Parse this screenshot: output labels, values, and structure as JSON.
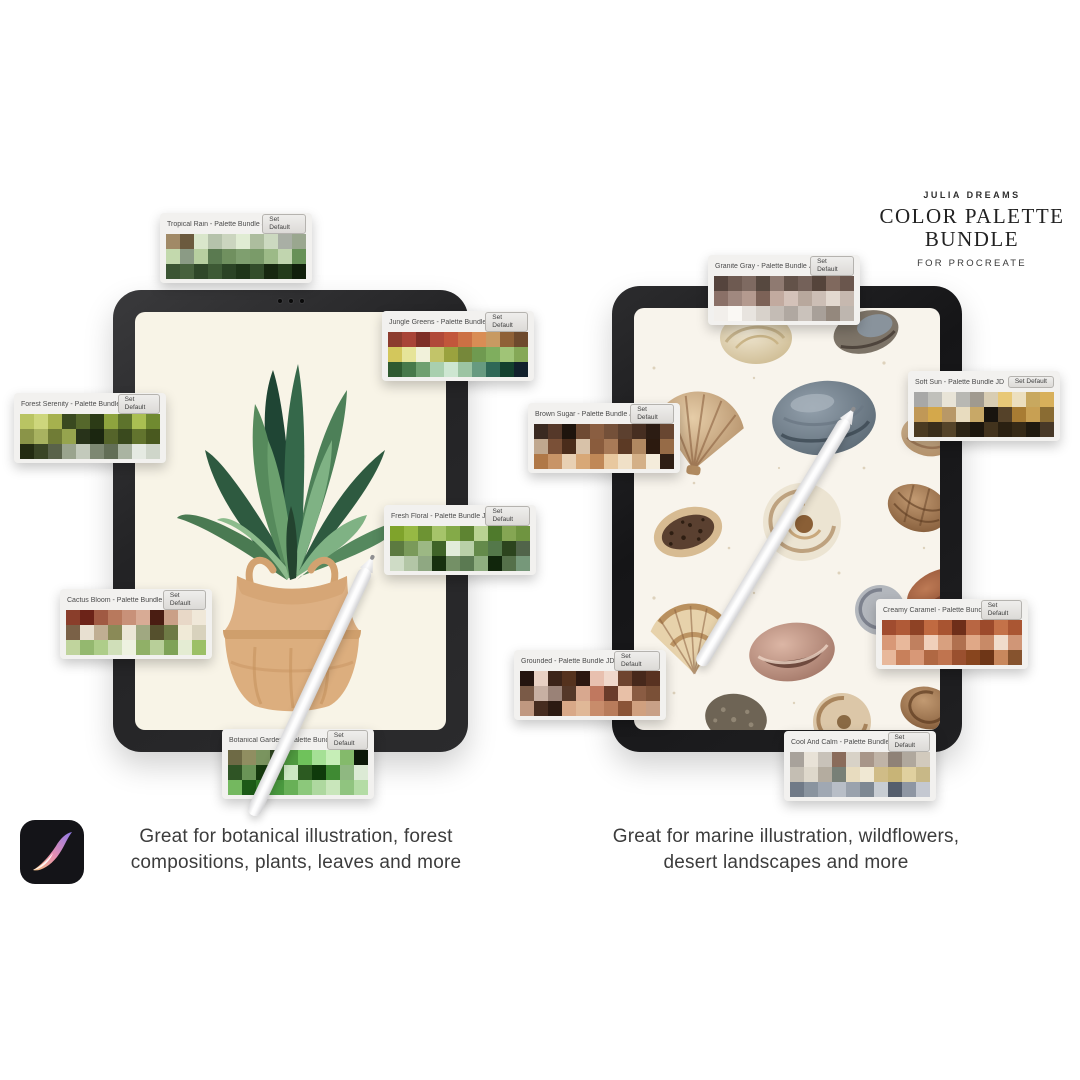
{
  "header": {
    "brand": "JULIA DREAMS",
    "title_line1": "COLOR PALETTE",
    "title_line2": "BUNDLE",
    "subtitle": "FOR PROCREATE"
  },
  "captions": {
    "left": "Great for botanical illustration, forest compositions, plants, leaves and more",
    "right": "Great for marine illustration, wildflowers, desert landscapes and more"
  },
  "palette_ui": {
    "set_default_label": "Set Default"
  },
  "icons": {
    "procreate": "procreate-app-icon"
  },
  "palettes": [
    {
      "name": "Tropical Rain - Palette Bundle JD",
      "rows": [
        [
          "#a18a67",
          "#6b5a3e",
          "#d9e6cb",
          "#b5c2ab",
          "#cbd5bf",
          "#e0ecd3",
          "#adbd9e",
          "#ccd9c0",
          "#a9afa5",
          "#9aa78f"
        ],
        [
          "#c3d9ad",
          "#8b9b85",
          "#b7cfa0",
          "#5a7a50",
          "#70905f",
          "#7f9f6f",
          "#7a9b69",
          "#9cba87",
          "#c1d5af",
          "#679157"
        ],
        [
          "#3b5533",
          "#47613d",
          "#2f4729",
          "#3d5935",
          "#2b4325",
          "#1f3519",
          "#334d2b",
          "#172810",
          "#233b1b",
          "#101f0b"
        ]
      ]
    },
    {
      "name": "Jungle Greens - Palette Bundle JD",
      "rows": [
        [
          "#8c3c2e",
          "#a84437",
          "#7e2f27",
          "#b04939",
          "#c2563b",
          "#cc7044",
          "#d98d55",
          "#c89a62",
          "#8f6137",
          "#6e4a2d"
        ],
        [
          "#d3c75c",
          "#e6e499",
          "#f1f1da",
          "#c2c469",
          "#9aa23e",
          "#76883a",
          "#6f9a50",
          "#7fae5e",
          "#a0c477",
          "#85a857"
        ],
        [
          "#2f5a30",
          "#47794a",
          "#6fa070",
          "#a9cfae",
          "#cde6d1",
          "#9cc4a3",
          "#679a80",
          "#2f6857",
          "#13402e",
          "#11202c"
        ]
      ]
    },
    {
      "name": "Forest Serenity - Palette Bundle JD",
      "rows": [
        [
          "#b9c463",
          "#cdd67c",
          "#a6b14e",
          "#39491f",
          "#55672b",
          "#2c3b16",
          "#8ea43e",
          "#5d732c",
          "#aabf52",
          "#708a30"
        ],
        [
          "#8a9448",
          "#a8b260",
          "#707c36",
          "#96a44e",
          "#28331a",
          "#1b2610",
          "#55642a",
          "#3a4a1e",
          "#62742e",
          "#49591f"
        ],
        [
          "#232b12",
          "#3a4526",
          "#59624a",
          "#9aa48e",
          "#c3cabc",
          "#7d8872",
          "#626e56",
          "#aab4a2",
          "#e5eae2",
          "#cfd6ca"
        ]
      ]
    },
    {
      "name": "Fresh Floral - Palette Bundle JD",
      "rows": [
        [
          "#7fa32b",
          "#97b944",
          "#6d9333",
          "#a6c46a",
          "#84aa48",
          "#5e8432",
          "#b9d292",
          "#4f7a2c",
          "#85a653",
          "#6f9440"
        ],
        [
          "#5c7a40",
          "#7a9a5a",
          "#9cb884",
          "#3f6328",
          "#e2ecda",
          "#b9d0a8",
          "#648a4a",
          "#54784a",
          "#2c441e",
          "#51644a"
        ],
        [
          "#cfdcc6",
          "#b3c6a6",
          "#8fa882",
          "#17300f",
          "#749066",
          "#5b7a52",
          "#8fae80",
          "#11260c",
          "#55704a",
          "#76987a"
        ]
      ]
    },
    {
      "name": "Cactus Bloom - Palette Bundle JD",
      "rows": [
        [
          "#8a3e2b",
          "#6c2318",
          "#a05a43",
          "#b8795d",
          "#c89179",
          "#d8ab95",
          "#4a1d12",
          "#caa087",
          "#e8d8c7",
          "#f0e8d9"
        ],
        [
          "#7a6147",
          "#e8e0d1",
          "#c0ae93",
          "#8a8a57",
          "#ece6d7",
          "#a0a881",
          "#55502d",
          "#6e7a45",
          "#f0ead7",
          "#d8d2bd"
        ],
        [
          "#c0d49d",
          "#94b86f",
          "#aecd89",
          "#d0dfb9",
          "#eef2e1",
          "#90b067",
          "#b8cf99",
          "#7ea257",
          "#e4ecd3",
          "#9cc067"
        ]
      ]
    },
    {
      "name": "Botanical Garden - Palette Bundle JD",
      "rows": [
        [
          "#6e6a45",
          "#908e61",
          "#7a945f",
          "#2c421f",
          "#4f9a3f",
          "#6fc25b",
          "#a5e095",
          "#c6eeb7",
          "#84ba6b",
          "#0c1809"
        ],
        [
          "#2f5425",
          "#6a9457",
          "#163a0f",
          "#3a7a2d",
          "#cde8c3",
          "#2c5a21",
          "#0f3a0b",
          "#3f8a33",
          "#8fb881",
          "#dcead5"
        ],
        [
          "#74b85f",
          "#1c5a17",
          "#2f7a27",
          "#4a9a3f",
          "#68b057",
          "#8cc87b",
          "#aed89f",
          "#c9e6bb",
          "#90c47f",
          "#b4dca5"
        ]
      ]
    },
    {
      "name": "Granite Gray - Palette Bundle JD",
      "rows": [
        [
          "#55443d",
          "#6e5a51",
          "#7e6a61",
          "#56483f",
          "#8f7a71",
          "#635249",
          "#746159",
          "#55443b",
          "#80695e",
          "#6a564d"
        ],
        [
          "#8a7067",
          "#a0887f",
          "#b49a8f",
          "#7c6257",
          "#c2aa9f",
          "#d4c2b9",
          "#b8a89d",
          "#ccbeb5",
          "#e2d8cf",
          "#c6b8af"
        ],
        [
          "#f2efeb",
          "#faf8f4",
          "#e8e4df",
          "#d8d2cb",
          "#c4bcb5",
          "#b0a8a1",
          "#cac2bb",
          "#a8a099",
          "#94887d",
          "#beb6af"
        ]
      ]
    },
    {
      "name": "Soft Sun - Palette Bundle JD",
      "rows": [
        [
          "#a8a8a7",
          "#c0c0bb",
          "#e8e4d7",
          "#b8b8b3",
          "#a09a8f",
          "#d8cdb3",
          "#e8c877",
          "#ecdfbf",
          "#c8a85f",
          "#d8b05b"
        ],
        [
          "#c09857",
          "#d4a84b",
          "#b89867",
          "#e8dcbf",
          "#c8a867",
          "#18140f",
          "#554229",
          "#a87c33",
          "#c8a053",
          "#8a6c33"
        ],
        [
          "#4a3a21",
          "#3a2e1b",
          "#554429",
          "#2c2415",
          "#1c160d",
          "#42331d",
          "#2a2011",
          "#362a17",
          "#201a0f",
          "#473827"
        ]
      ]
    },
    {
      "name": "Brown Sugar - Palette Bundle JD",
      "rows": [
        [
          "#3a2a21",
          "#553829",
          "#1e140d",
          "#6e4a33",
          "#8a5e41",
          "#745039",
          "#5c402f",
          "#462e21",
          "#2c1c13",
          "#684631"
        ],
        [
          "#c0a88f",
          "#7a5037",
          "#4a2c1b",
          "#d8c2a9",
          "#8a5c3d",
          "#a87a57",
          "#5c3a25",
          "#b08861",
          "#2c1a0f",
          "#966b47"
        ],
        [
          "#b07847",
          "#c89467",
          "#e8d0b3",
          "#d8a877",
          "#c08857",
          "#e8c89f",
          "#f0e0c7",
          "#d4b087",
          "#f4ecdb",
          "#2e1e15"
        ]
      ]
    },
    {
      "name": "Creamy Caramel - Palette Bundle JD",
      "rows": [
        [
          "#a04c2f",
          "#b05a37",
          "#8e4225",
          "#c06a41",
          "#a85431",
          "#6e2e19",
          "#b86643",
          "#9c4a2b",
          "#c47249",
          "#aa5633"
        ],
        [
          "#d89877",
          "#e8b89b",
          "#c0805f",
          "#f0d0bb",
          "#d8a07f",
          "#b0704f",
          "#e0a887",
          "#c88a67",
          "#f0dccb",
          "#d09677"
        ],
        [
          "#e8b89b",
          "#c8805b",
          "#d89877",
          "#b06843",
          "#c0744f",
          "#9a502f",
          "#88451e",
          "#6e3617",
          "#c8885d",
          "#86532e"
        ]
      ]
    },
    {
      "name": "Grounded - Palette Bundle JD",
      "rows": [
        [
          "#24140f",
          "#e8d0c3",
          "#3c2419",
          "#55321e",
          "#2c1811",
          "#e8c0af",
          "#f0d8cb",
          "#6e442f",
          "#46281b",
          "#583221"
        ],
        [
          "#7a5a47",
          "#c8b0a3",
          "#9a8277",
          "#553829",
          "#d8a88f",
          "#c0785f",
          "#6a3c2b",
          "#e8c0a7",
          "#8a5c43",
          "#7a5037"
        ],
        [
          "#c09880",
          "#462c1f",
          "#2c1a11",
          "#d8a887",
          "#e0b897",
          "#c88c6b",
          "#b87c5b",
          "#8a5437",
          "#d0a07f",
          "#c8a087"
        ]
      ]
    },
    {
      "name": "Cool And Calm - Palette Bundle JD",
      "rows": [
        [
          "#a8a29b",
          "#e8e2d7",
          "#c8c2b9",
          "#8a6c5b",
          "#d8d2c7",
          "#a89689",
          "#c0b4a7",
          "#8f8277",
          "#b0a89d",
          "#d2cabd"
        ],
        [
          "#c4beb3",
          "#ded8cb",
          "#b4ac9f",
          "#788077",
          "#e8dcbf",
          "#f0e8d3",
          "#d0bc87",
          "#c8b477",
          "#e0d09f",
          "#c8b887"
        ],
        [
          "#707a87",
          "#8a949f",
          "#a0a8b3",
          "#b8bec7",
          "#9aa2ad",
          "#7e8893",
          "#c8cdd3",
          "#555e6d",
          "#8e96a3",
          "#c4c8d1"
        ]
      ]
    }
  ]
}
